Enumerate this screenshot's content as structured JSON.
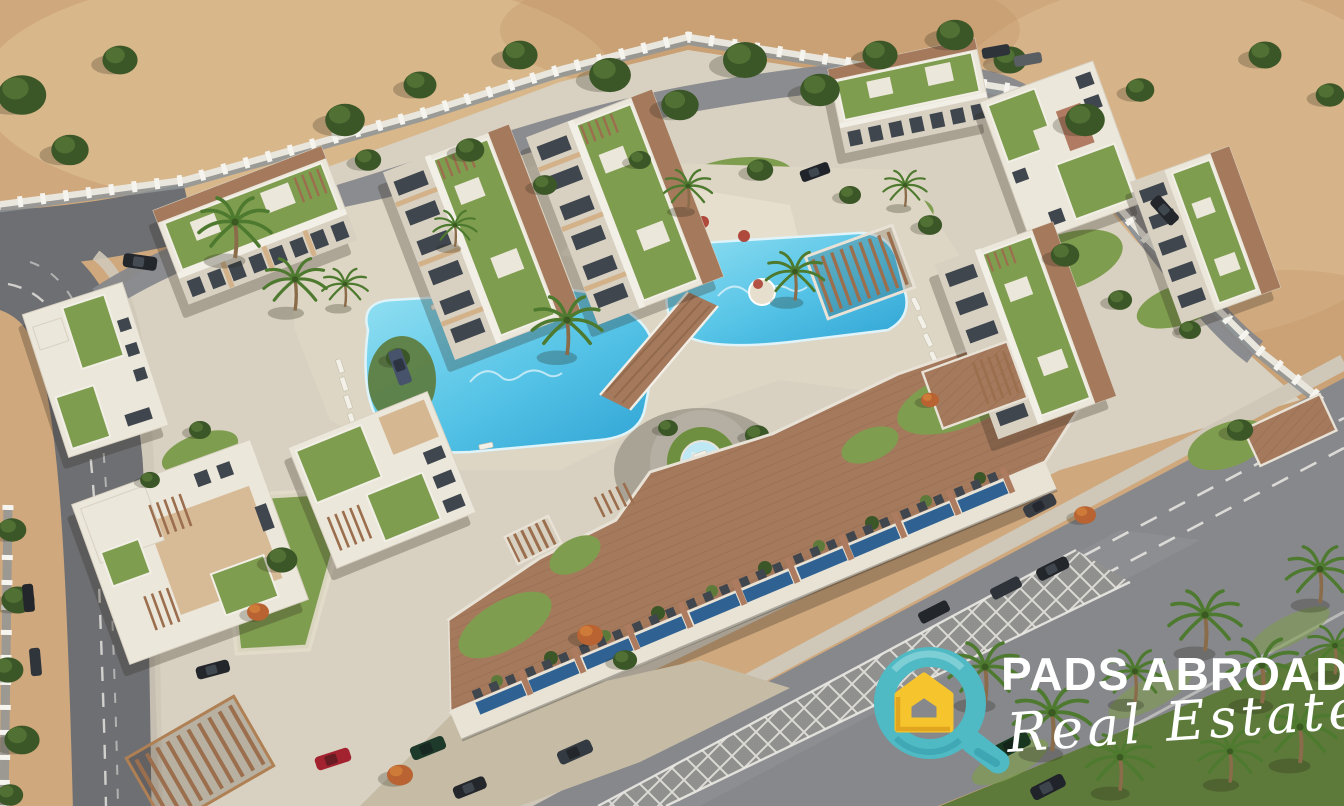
{
  "brand": {
    "name": "PADS ABROAD",
    "tagline": "Real Estate",
    "logo_icon": "magnifier-house-icon"
  },
  "scene": {
    "type": "aerial-3d-architectural-render",
    "subject": "residential resort compound with lagoon pools, roof gardens, perimeter roads and desert surroundings",
    "pool_floor_motif": "decorative script mosaic (illegible)",
    "colors": {
      "desert_sand": "#cfa87d",
      "desert_sand_light": "#e0c298",
      "desert_sand_dark": "#bf9468",
      "pavement": "#d8d1c1",
      "deck": "#ded6c4",
      "deck_light": "#e6dfcd",
      "forecourt": "#c6bca6",
      "road_asphalt": "#87888c",
      "road_asphalt_dark": "#6e6f73",
      "lane_white": "#ebe9e3",
      "sidewalk": "#cfc8b8",
      "pool_light": "#93e0f2",
      "pool_mid": "#55c3e6",
      "pool_deep": "#2fa3d4",
      "lawn": "#7f9d4f",
      "lawn_dark": "#5d7a3a",
      "tree_green": "#3c5727",
      "tree_green_light": "#557436",
      "palm_green": "#4e7a2f",
      "orange_tree": "#b86331",
      "roof_brown": "#a5795c",
      "pergola_wood": "#9b6f4e",
      "building_white": "#ece7db",
      "building_trim": "#d8d1c2",
      "building_tan": "#d3b28a",
      "window_dark": "#3f464e",
      "storefront_blue": "#2f6292",
      "wall_light": "#e9e6de",
      "wall_gray": "#8f9598",
      "wall_pillar": "#f6f4ee",
      "logo_teal": "#4fb9c4",
      "logo_teal_dark": "#2f97a4",
      "logo_yellow": "#f6c52e",
      "logo_yellow_dark": "#dd9f1d",
      "logo_text": "#ffffff"
    }
  }
}
